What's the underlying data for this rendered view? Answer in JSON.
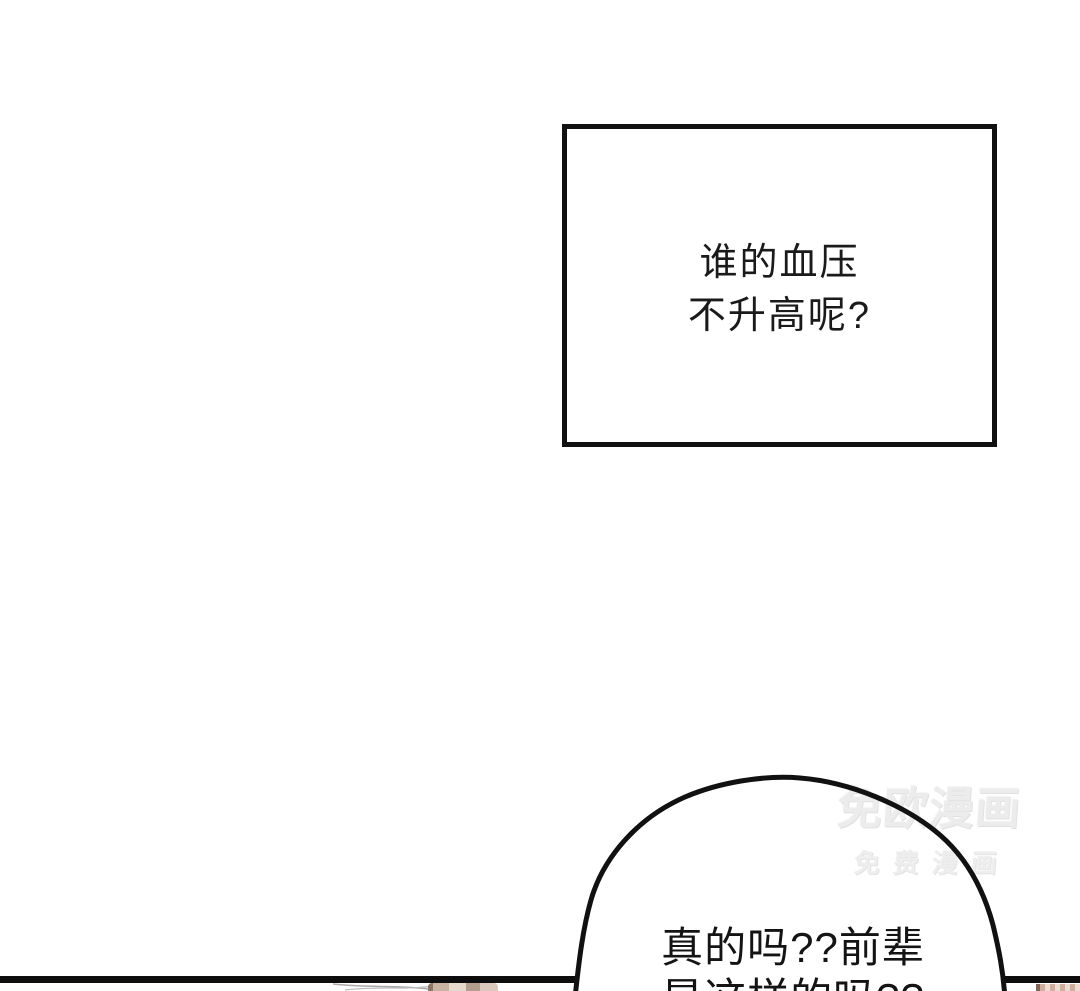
{
  "page": {
    "background_color": "#ffffff",
    "width": 1080,
    "height": 991
  },
  "caption_box": {
    "lines": [
      "谁的血压",
      "不升高呢?"
    ],
    "border_color": "#111111",
    "text_color": "#1a1a1a"
  },
  "speech_bubble": {
    "lines": [
      "真的吗??前辈",
      "是这样的吗??"
    ],
    "outline_color": "#111111",
    "fill_color": "#ffffff"
  },
  "watermark": {
    "line1": "免欧漫画",
    "line2": "免费漫画",
    "color": "#ececec"
  },
  "divider": {
    "color": "#0d0d0d"
  },
  "next_panel_peek": {
    "blob_colors": [
      "#8d7668",
      "#c9b4a3",
      "#e6d9cd",
      "#b49e8d",
      "#d9c8bb"
    ],
    "stripe_colors": [
      "#cfae9e",
      "#ecdcd2"
    ],
    "stripe_cap_color": "#7e6557"
  }
}
